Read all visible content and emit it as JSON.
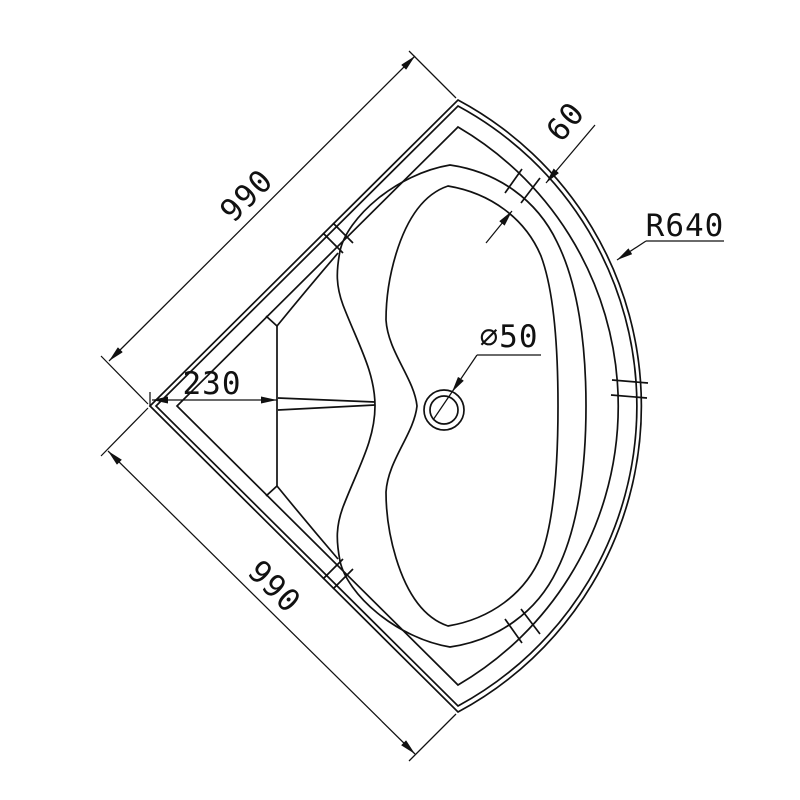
{
  "drawing": {
    "type": "technical-plan-quadrant-shower-tray",
    "colors": {
      "background": "#ffffff",
      "line": "#111111"
    },
    "dimensions": {
      "edge_top": {
        "label": "990",
        "meaning": "top-left straight edge length"
      },
      "edge_bottom": {
        "label": "990",
        "meaning": "bottom-left straight edge length"
      },
      "seat_depth": {
        "label": "230",
        "meaning": "corner to seat front face"
      },
      "rim_width": {
        "label": "60",
        "meaning": "rim width across front edge"
      },
      "drain_diameter": {
        "label": "⌀50",
        "meaning": "waste/drain hole diameter"
      },
      "front_radius": {
        "label": "R640",
        "meaning": "curved front radius"
      }
    }
  }
}
